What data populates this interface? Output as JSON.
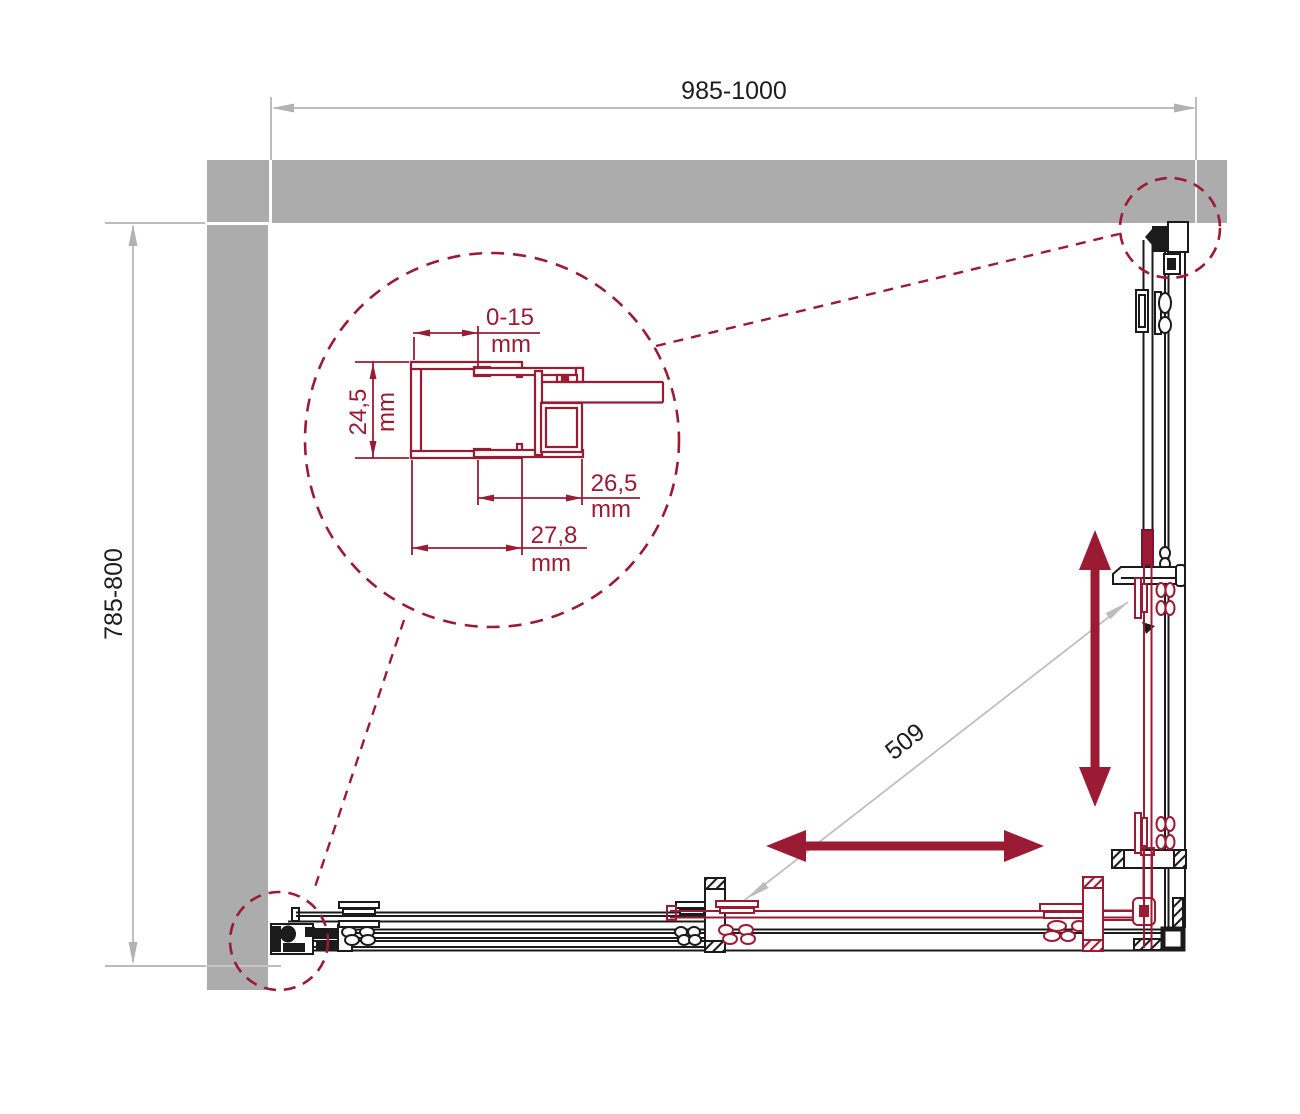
{
  "drawing": {
    "type": "shower-enclosure-top-view-technical-drawing",
    "labels": {
      "width_range": "985-1000",
      "depth_range": "785-800",
      "diagonal_opening": "509",
      "adjust_range": "0-15",
      "adjust_unit": "mm",
      "profile_depth": "24,5",
      "profile_depth_unit": "mm",
      "glass_offset": "26,5",
      "glass_offset_unit": "mm",
      "profile_width": "27,8",
      "profile_width_unit": "mm"
    },
    "colors": {
      "wall_gray": "#acacac",
      "dimension_gray": "#b2b2b2",
      "accent_red": "#9b1b35",
      "line_black": "#1b1b1b"
    }
  }
}
